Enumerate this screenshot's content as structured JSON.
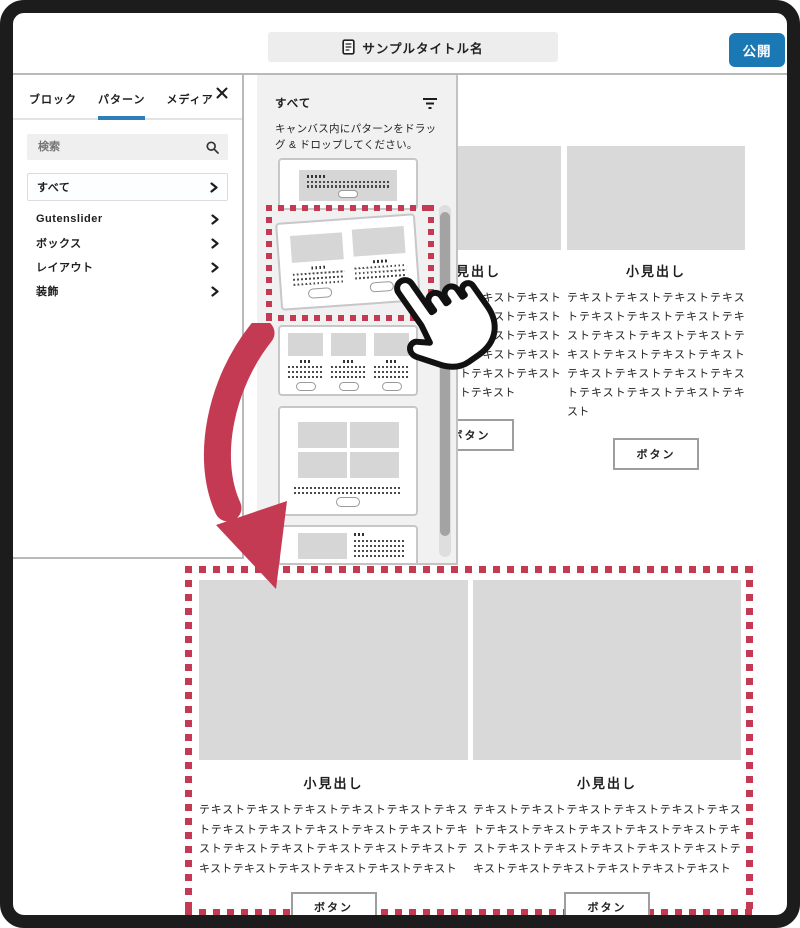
{
  "topbar": {
    "title": "サンプルタイトル名",
    "publish_label": "公開"
  },
  "sidebar": {
    "tabs": [
      {
        "label": "ブロック"
      },
      {
        "label": "パターン"
      },
      {
        "label": "メディア"
      }
    ],
    "search_placeholder": "検索",
    "items": [
      {
        "label": "すべて"
      },
      {
        "label": "Gutenslider"
      },
      {
        "label": "ボックス"
      },
      {
        "label": "レイアウト"
      },
      {
        "label": "装飾"
      }
    ]
  },
  "panel": {
    "header": "すべて",
    "instruction": "キャンバス内にパターンをドラッグ & ドロップしてください。"
  },
  "content": {
    "heading": "小見出し",
    "body_text": "テキストテキストテキストテキストテキストテキストテキストテキストテキストテキストテキストテキストテキストテキストテキストテキストテキストテキストテキストテキストテキストテキストテキスト",
    "button_label": "ボタン"
  },
  "colors": {
    "accent_blue": "#1a79b5",
    "accent_red": "#c43a52"
  }
}
